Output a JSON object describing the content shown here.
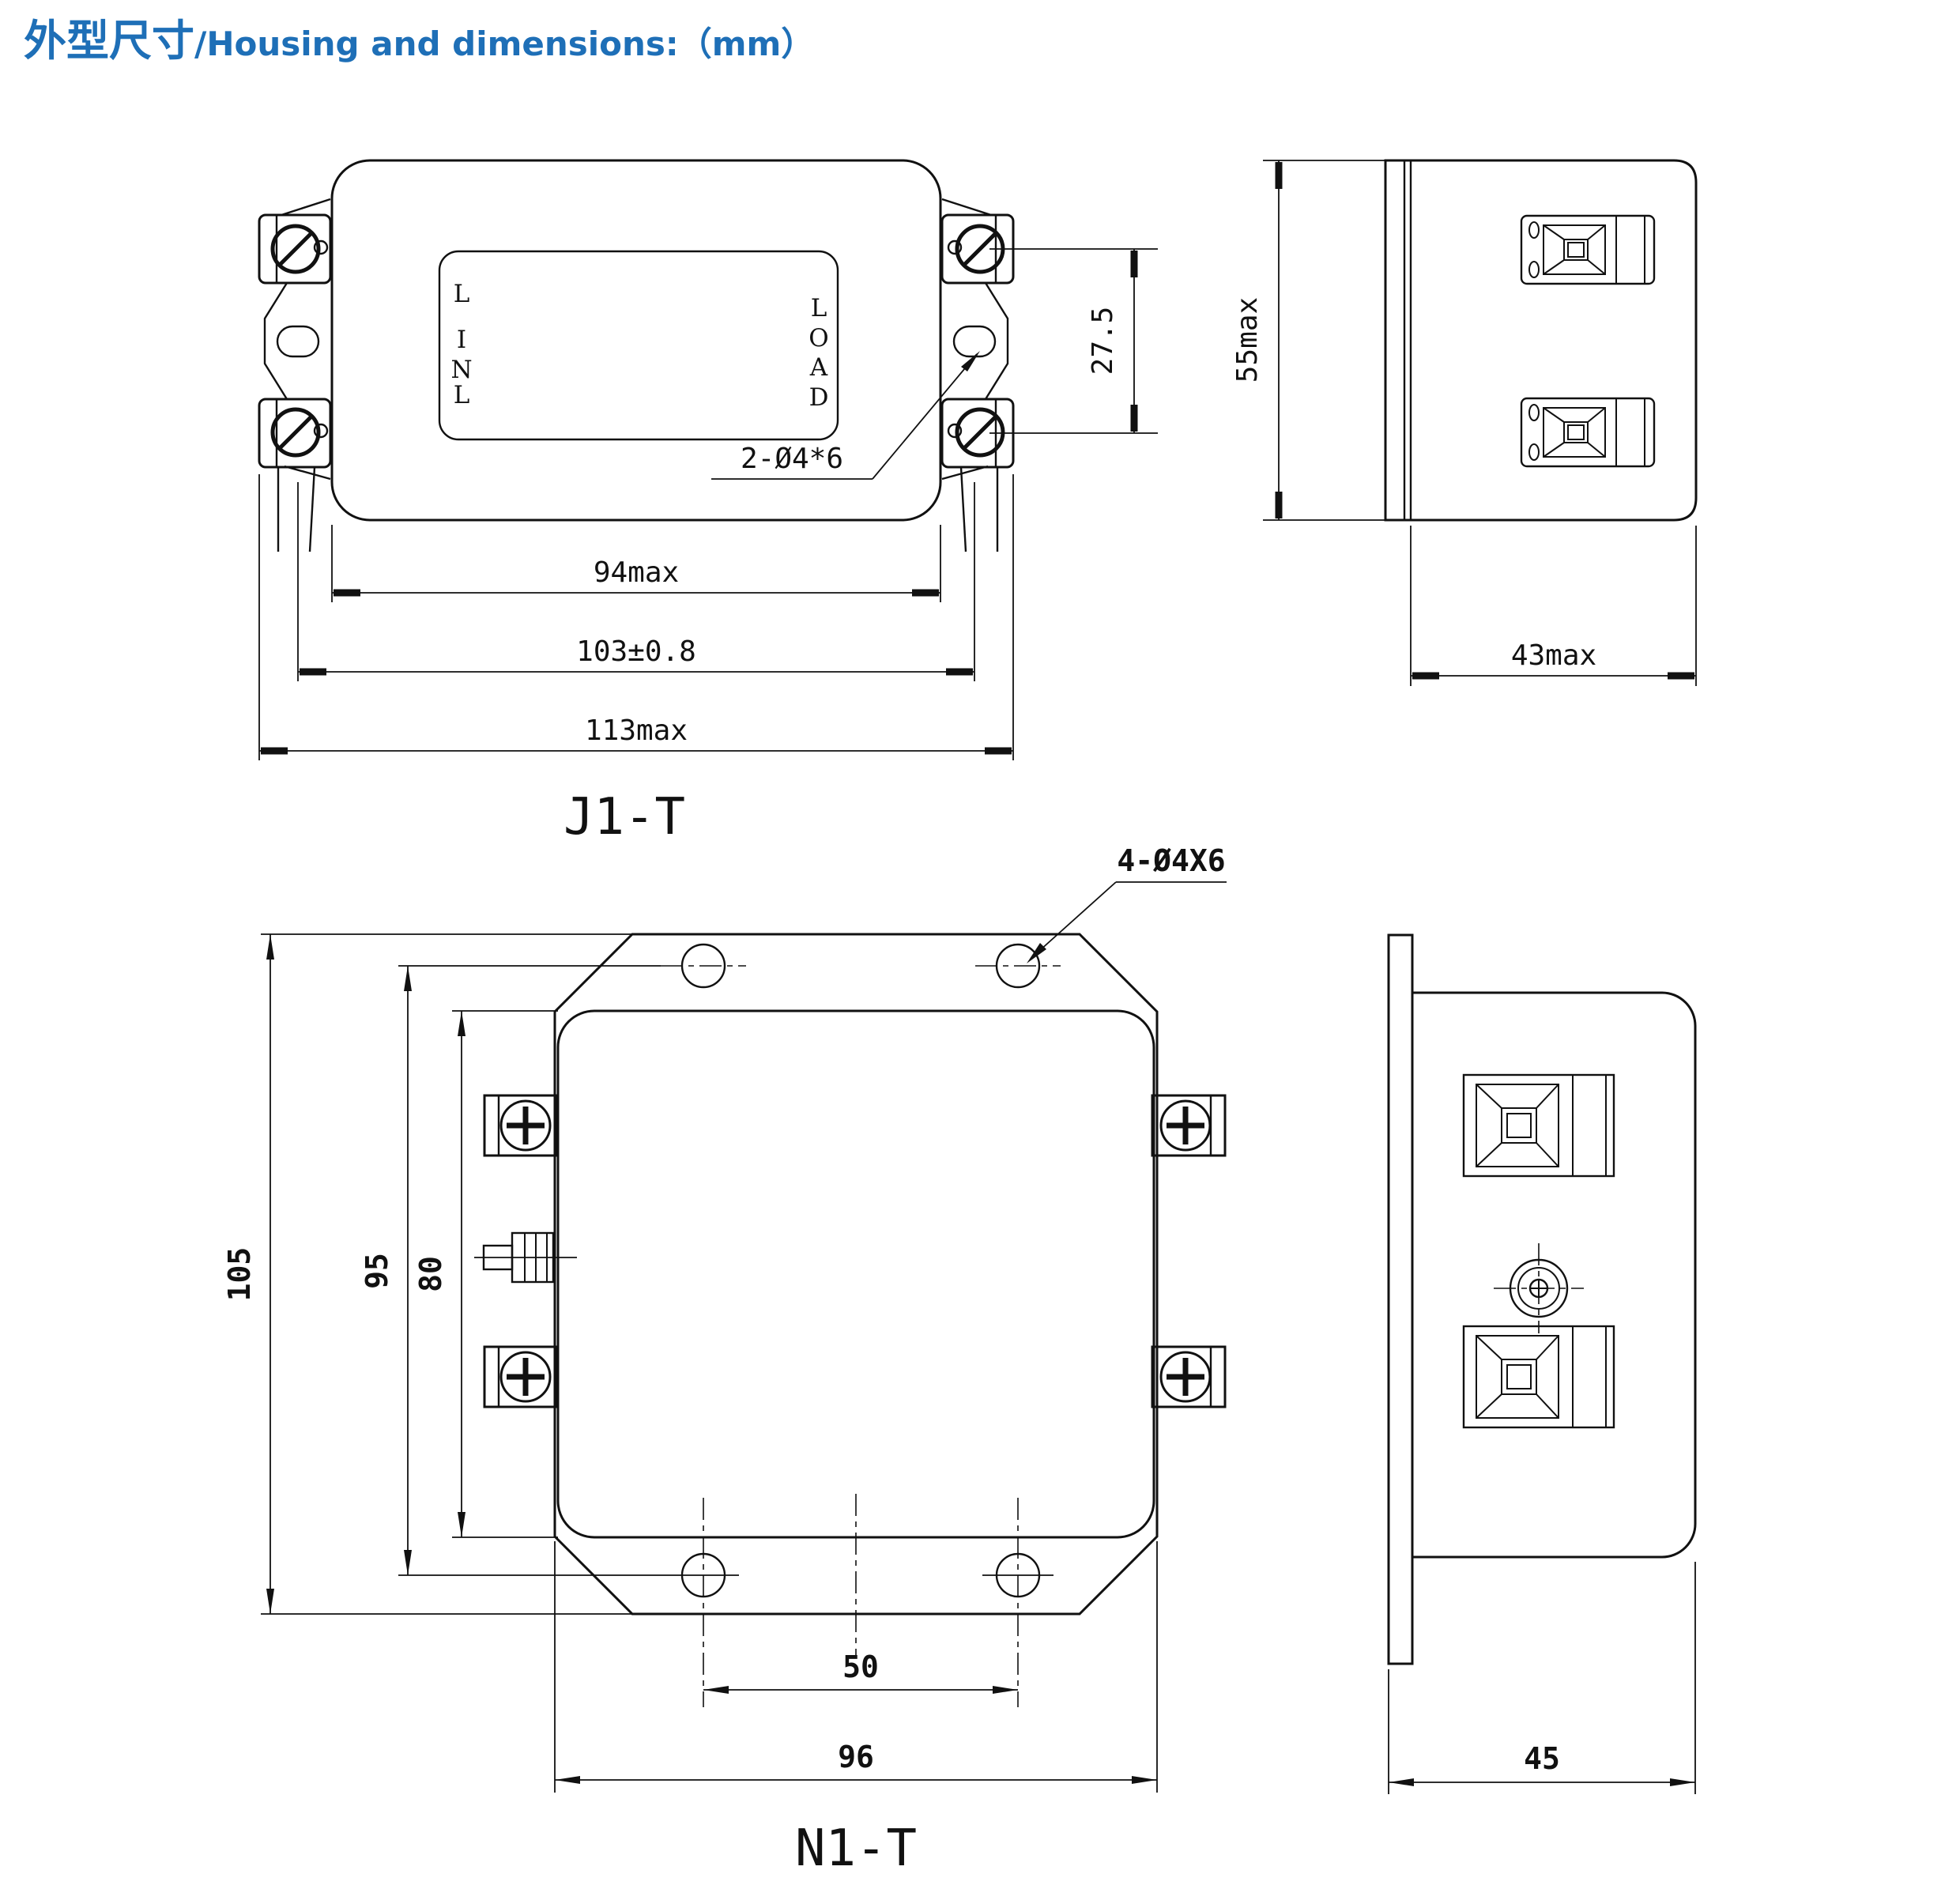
{
  "title": {
    "zh": "外型尺寸",
    "sep": "/",
    "en": "Housing and dimensions:（mm）"
  },
  "colors": {
    "accent": "#1e6fb7",
    "line": "#111111",
    "background": "#ffffff"
  },
  "j1t_front": {
    "caption": "J1-T",
    "label_left": [
      "L",
      "I",
      "N",
      "L"
    ],
    "label_right": [
      "L",
      "O",
      "A",
      "D"
    ],
    "dim_body_width": "94max",
    "dim_hole_span": "103±0.8",
    "dim_overall_width": "113max",
    "dim_terminal_span": "27.5",
    "note_mount_holes": "2-Ø4*6"
  },
  "j1t_side": {
    "dim_height": "55max",
    "dim_depth": "43max"
  },
  "n1t_front": {
    "caption": "N1-T",
    "dim_overall_height": "105",
    "dim_hole_span_vertical": "95",
    "dim_body_height": "80",
    "dim_hole_span_horizontal": "50",
    "dim_overall_width": "96",
    "note_mount_holes": "4-Ø4X6"
  },
  "n1t_side": {
    "dim_depth": "45"
  }
}
